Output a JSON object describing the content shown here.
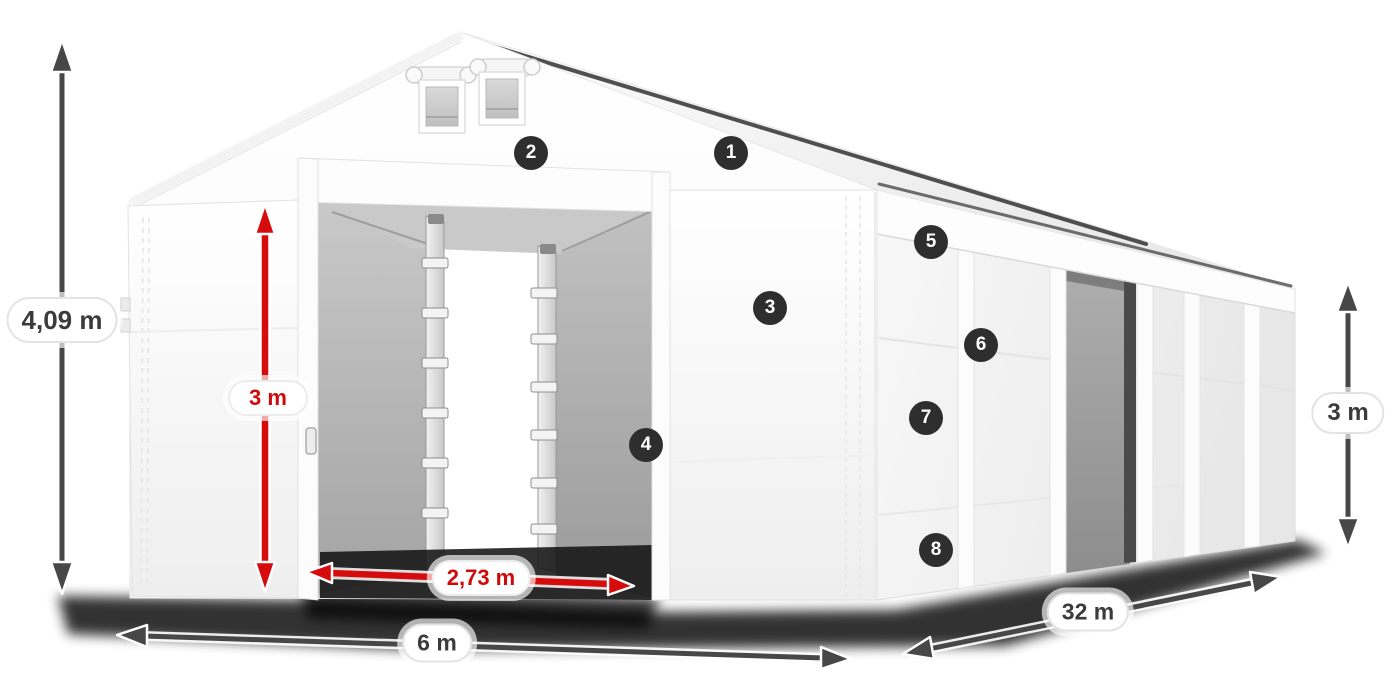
{
  "diagram": {
    "subject": "White tarpaulin storage tent shown in three-quarter front view with dimension arrows and numbered feature markers",
    "background_color": "#ffffff",
    "tent_color": "#f7f7f7",
    "interior_color": "#b5b5b5",
    "units": "m"
  },
  "dimensions": {
    "total_height": {
      "label": "4,09 m",
      "text_color": "#3b3b3b",
      "arrow_color": "#474747",
      "orientation": "vertical",
      "location": "far left of tent"
    },
    "inner_height": {
      "label": "3 m",
      "text_color": "#cf0a0a",
      "arrow_color": "#d60c0c",
      "orientation": "vertical",
      "location": "front door, inner clearance height"
    },
    "door_width": {
      "label": "2,73 m",
      "text_color": "#cf0a0a",
      "arrow_color": "#d60c0c",
      "orientation": "horizontal",
      "location": "front door opening width"
    },
    "width": {
      "label": "6 m",
      "text_color": "#3b3b3b",
      "arrow_color": "#474747",
      "orientation": "horizontal",
      "location": "front width at ground"
    },
    "length": {
      "label": "32 m",
      "text_color": "#3b3b3b",
      "arrow_color": "#474747",
      "orientation": "diagonal",
      "location": "side length at ground"
    },
    "side_height": {
      "label": "3 m",
      "text_color": "#3b3b3b",
      "arrow_color": "#474747",
      "orientation": "vertical",
      "location": "right side wall height"
    }
  },
  "feature_badges": [
    {
      "number": "1"
    },
    {
      "number": "2"
    },
    {
      "number": "3"
    },
    {
      "number": "4"
    },
    {
      "number": "5"
    },
    {
      "number": "6"
    },
    {
      "number": "7"
    },
    {
      "number": "8"
    }
  ],
  "badge_style": {
    "background": "#2e2e2e",
    "text_color": "#ffffff"
  }
}
